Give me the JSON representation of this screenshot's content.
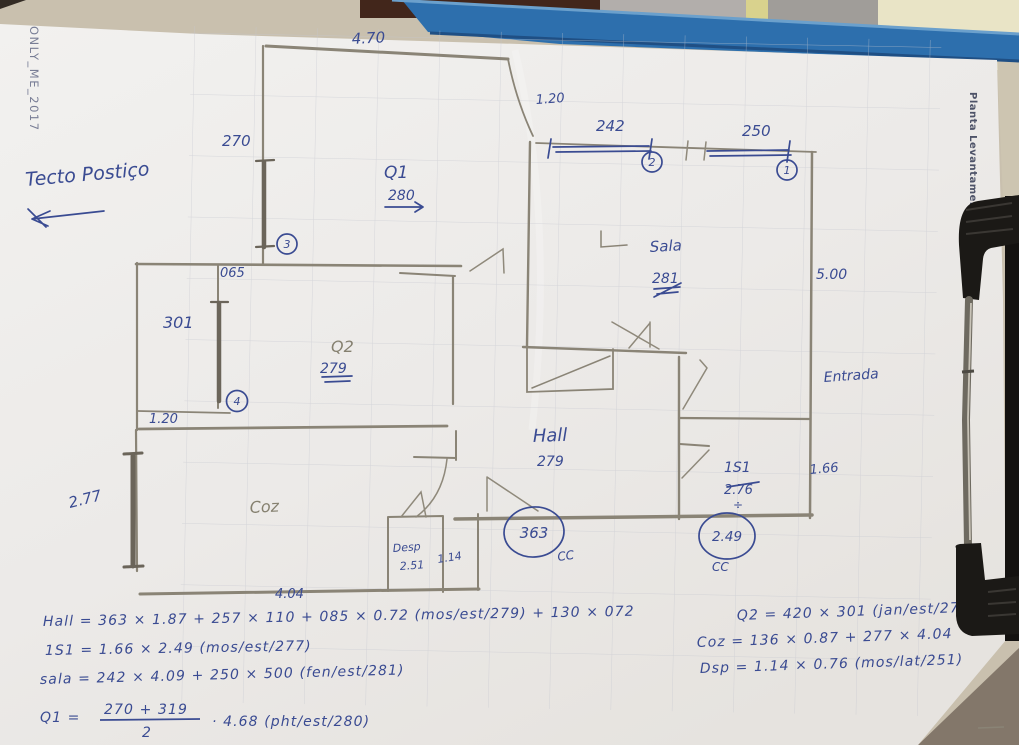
{
  "photo": {
    "watermark": "ONLY_ME_2017",
    "side_label": "Planta Levantamento",
    "colors": {
      "ink": "#3a4b92",
      "pencil": "#8a8476",
      "board_blue": "#2d6fad",
      "paper": "#efedea"
    }
  },
  "notes": {
    "ceiling": "Tecto Postiço"
  },
  "plan": {
    "labels": {
      "top_width": "4.70",
      "window3_len": "270",
      "door_top": "1.20",
      "window2_len": "242",
      "window2_num": "2",
      "window1_len": "250",
      "window1_num": "1",
      "q1_name": "Q1",
      "q1_depth": "280",
      "window3_num": "3",
      "gap_065": "065",
      "window4_len": "301",
      "window4_num": "4",
      "door_left": "1.20",
      "q2_name": "Q2",
      "q2_depth": "279",
      "sala_name": "Sala",
      "sala_depth": "281",
      "right_height": "5.00",
      "entrada": "Entrada",
      "hall_name": "Hall",
      "hall_depth": "279",
      "hall_width": "363",
      "hall_cc": "CC",
      "is1_name": "1S1",
      "is1_depth": "2.76",
      "is1_div": "÷",
      "is1_width": "2.49",
      "is1_cc": "CC",
      "corridor_width": "1.66",
      "left_height": "2.77",
      "coz_name": "Coz",
      "desp_name": "Desp",
      "desp_depth": "2.51",
      "desp_width": "1.14",
      "coz_width": "4.04"
    }
  },
  "formulas": {
    "hall": "Hall = 363 × 1.87 + 257 × 110 + 085 × 0.72 (mos/est/279) + 130 × 072",
    "q2": "Q2 = 420 × 301 (jan/est/279)",
    "is1": "1S1 = 1.66 × 2.49 (mos/est/277)",
    "coz": "Coz = 136 × 0.87 + 277 × 4.04",
    "sala": "sala = 242 × 4.09 + 250 × 500 (fen/est/281)",
    "dsp": "Dsp = 1.14 × 0.76 (mos/lat/251)",
    "q1": {
      "lhs": "Q1 =",
      "numerator": "270 + 319",
      "denominator": "2",
      "rhs": "· 4.68 (pht/est/280)"
    }
  }
}
